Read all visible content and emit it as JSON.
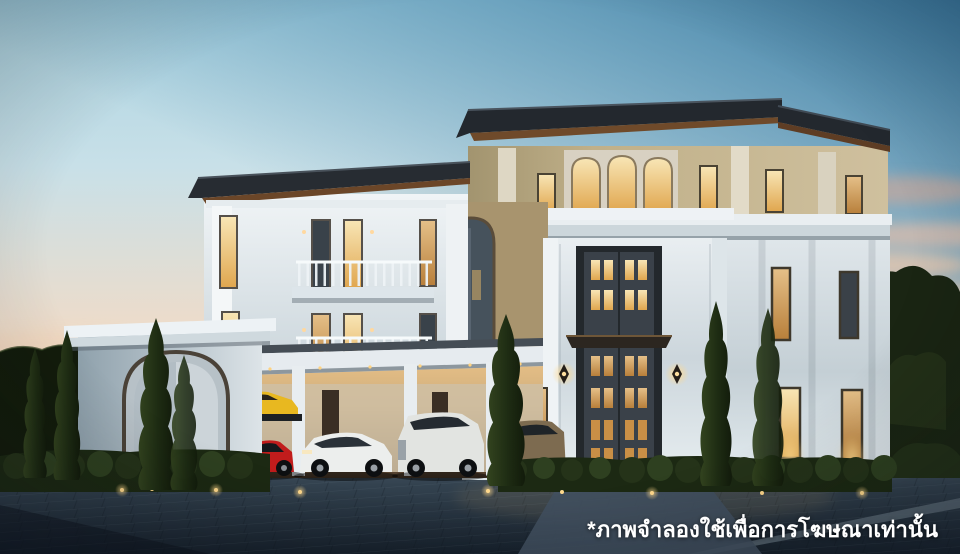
{
  "caption": {
    "text": "*ภาพจำลองใช้เพื่อการโฆษณาเท่านั้น"
  },
  "scene": {
    "subject": "luxury-mansion-dusk-render",
    "time_of_day": "dusk"
  },
  "palette": {
    "sky_top_left": "#c6e1ea",
    "sky_top_right": "#3f80a6",
    "sky_horizon": "#f6dcc2",
    "cloud_pink": "#e9b9a6",
    "wall_cream": "#c3b38d",
    "wall_marble": "#dfe6ea",
    "roof_dark": "#23282e",
    "soffit_brown": "#6b4628",
    "window_glow": "#f2c27a",
    "pavement": "#2c3b4a",
    "tree_green": "#1d2a16",
    "caption_color": "#ffffff"
  },
  "vehicles": [
    {
      "name": "sports-car-on-lift",
      "color": "#e8b820"
    },
    {
      "name": "sports-car",
      "color": "#c11c1c"
    },
    {
      "name": "sports-sedan",
      "color": "#eceeed"
    },
    {
      "name": "suv-white",
      "color": "#e2e4e1"
    },
    {
      "name": "suv-bronze",
      "color": "#7d6b50"
    }
  ]
}
